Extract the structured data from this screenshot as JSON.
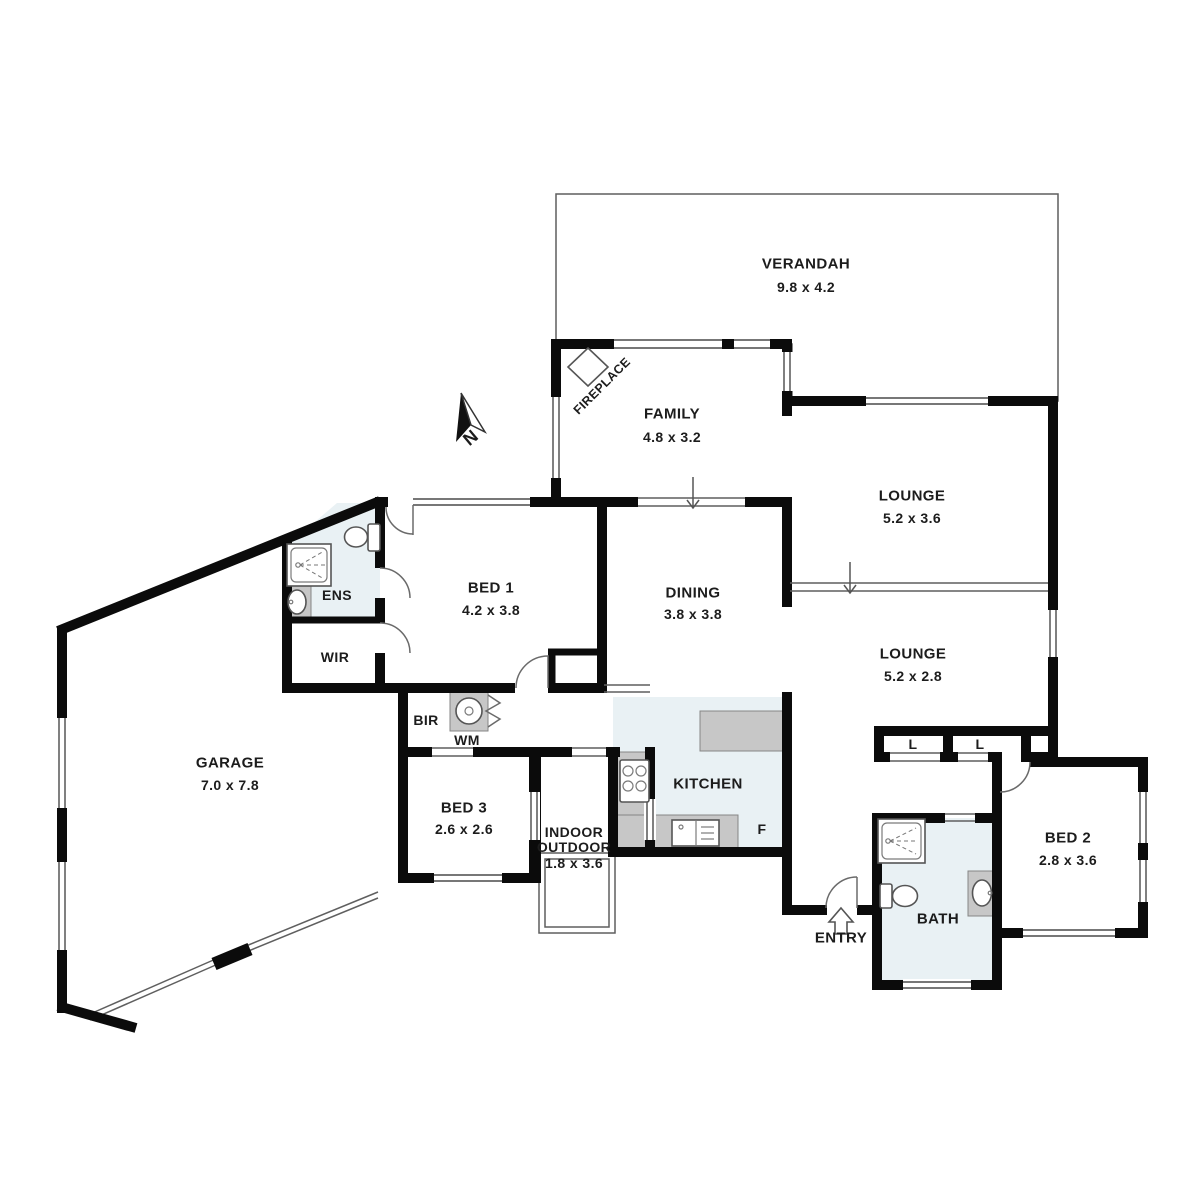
{
  "plan_type": "residential-floor-plan",
  "colors": {
    "wall": "#0b0b0b",
    "wet_area_fill": "#e9f1f4",
    "counter_fill": "#c7c7c7",
    "background": "#ffffff"
  },
  "compass": {
    "north": "N"
  },
  "rooms": {
    "verandah": {
      "name": "VERANDAH",
      "dims": "9.8 x 4.2"
    },
    "family": {
      "name": "FAMILY",
      "dims": "4.8 x 3.2"
    },
    "lounge_top": {
      "name": "LOUNGE",
      "dims": "5.2 x 3.6"
    },
    "lounge_bottom": {
      "name": "LOUNGE",
      "dims": "5.2 x 2.8"
    },
    "dining": {
      "name": "DINING",
      "dims": "3.8 x 3.8"
    },
    "bed1": {
      "name": "BED 1",
      "dims": "4.2 x 3.8"
    },
    "bed2": {
      "name": "BED 2",
      "dims": "2.8 x 3.6"
    },
    "bed3": {
      "name": "BED 3",
      "dims": "2.6 x 2.6"
    },
    "garage": {
      "name": "GARAGE",
      "dims": "7.0 x 7.8"
    },
    "indoor_outdoor": {
      "line1": "INDOOR",
      "line2": "OUTDOOR",
      "dims": "1.8 x 3.6"
    },
    "kitchen": {
      "name": "KITCHEN"
    },
    "bath": {
      "name": "BATH"
    },
    "ens": {
      "name": "ENS"
    },
    "wir": {
      "name": "WIR"
    },
    "bir": {
      "name": "BIR"
    },
    "laundry": {
      "name": "WM"
    },
    "fridge": {
      "name": "F"
    },
    "entry": {
      "name": "ENTRY"
    },
    "linen_left": {
      "name": "L"
    },
    "linen_right": {
      "name": "L"
    },
    "fireplace": {
      "name": "FIREPLACE"
    }
  }
}
